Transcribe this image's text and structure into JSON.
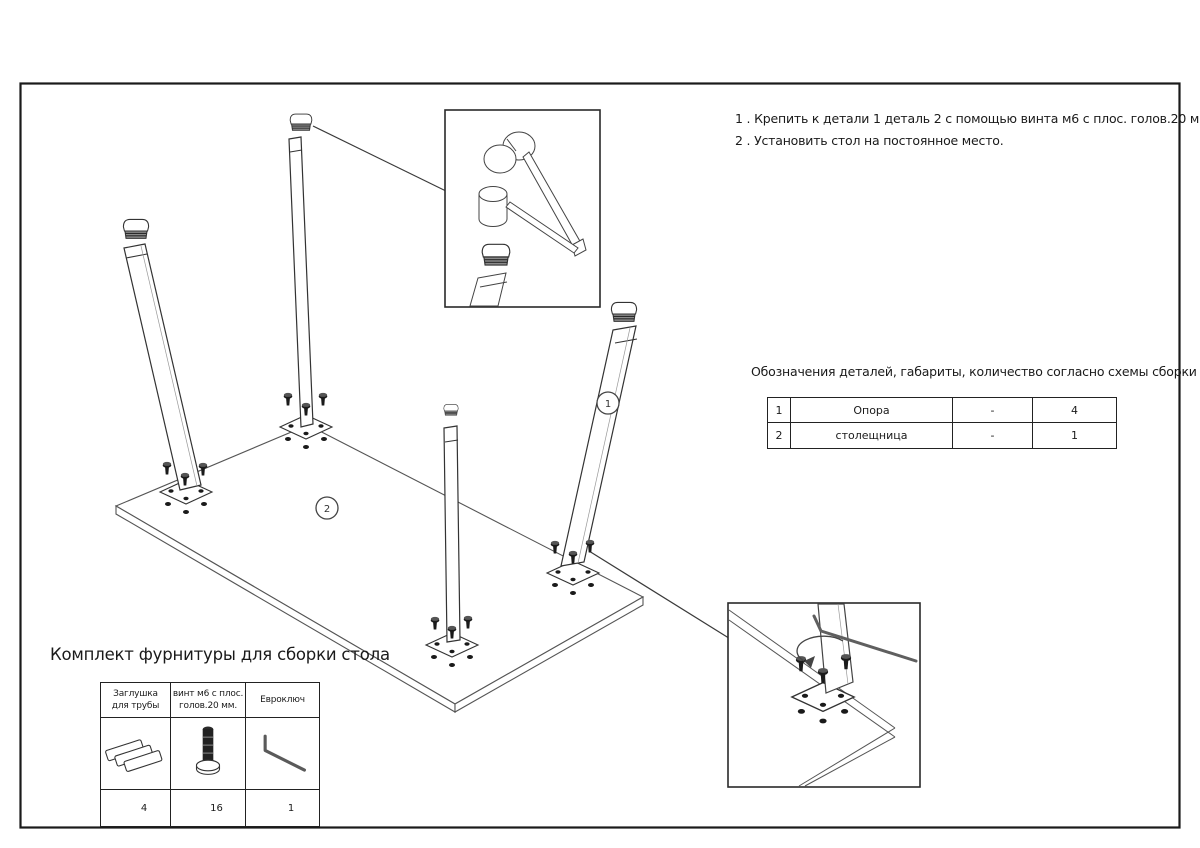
{
  "instructions": {
    "line1": "1 . Крепить к детали 1 деталь 2 с помощью винта м6 с плос. голов.20 мм.",
    "line2": "2 . Установить стол на постоянное место."
  },
  "parts": {
    "heading": "Обозначения деталей, габариты, количество согласно схемы сборки",
    "rows": [
      [
        "1",
        "Опора",
        "-",
        "4"
      ],
      [
        "2",
        "столещница",
        "-",
        "1"
      ]
    ]
  },
  "kit": {
    "title": "Комплект фурнитуры для сборки стола",
    "columns": [
      {
        "header_lines": [
          "Заглушка",
          "для трубы"
        ],
        "qty": "4",
        "icon": "pipe-plug-icon"
      },
      {
        "header_lines": [
          "винт м6 с плос.",
          "голов.20 мм."
        ],
        "qty": "16",
        "icon": "screw-icon"
      },
      {
        "header_lines": [
          "Евроключ",
          ""
        ],
        "qty": "1",
        "icon": "hex-key-icon"
      }
    ]
  },
  "diagram": {
    "callout_leg": "1",
    "callout_tabletop": "2"
  }
}
